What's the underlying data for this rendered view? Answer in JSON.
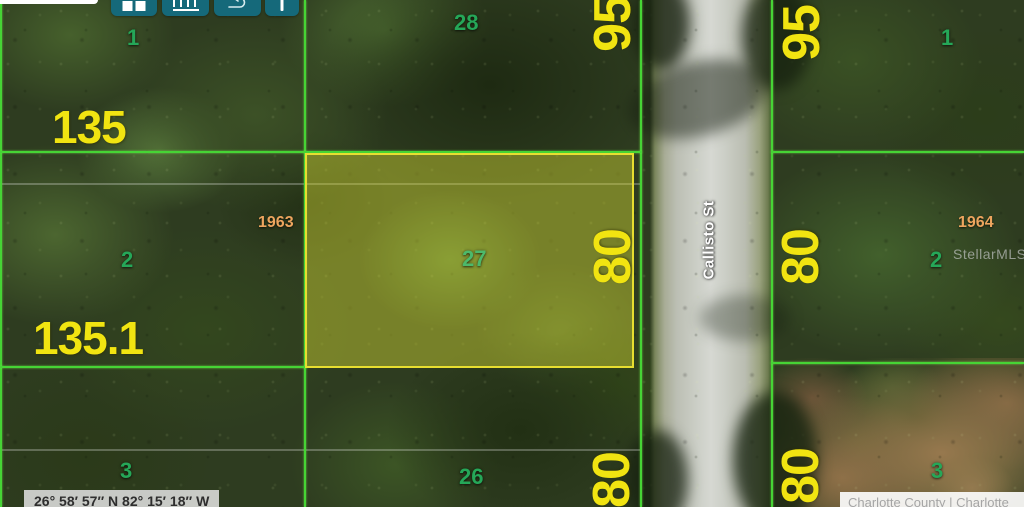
{
  "labels": {
    "street": "Callisto St",
    "watermark": "StellarMLS",
    "coordinates": "26° 58′ 57″ N 82° 15′ 18″ W",
    "attribution": "Charlotte County | Charlotte"
  },
  "toolbar": {
    "buttons": [
      {
        "icon": "grid-icon"
      },
      {
        "icon": "ruler-icon"
      },
      {
        "icon": "draw-arrow-icon"
      },
      {
        "icon": "marker-line-icon"
      }
    ]
  },
  "parcels": {
    "left": {
      "lot1": "1",
      "lot2": "2",
      "lot3": "3",
      "dim_top": "135",
      "dim_mid": "135.1",
      "parcel_id": "1963"
    },
    "center": {
      "lot_top": "28",
      "lot_highlight": "27",
      "lot_bottom": "26",
      "dim_top": "95",
      "dim_mid": "80",
      "dim_bottom": "80"
    },
    "right": {
      "lot1": "1",
      "lot2": "2",
      "lot3": "3",
      "dim_top": "95",
      "dim_mid": "80",
      "dim_bottom": "80",
      "parcel_id": "1964"
    }
  },
  "colors": {
    "boundary_green": "#46d435",
    "lot_number_green": "#25a758",
    "dimension_yellow": "#f1e411",
    "parcel_id_orange": "#eda55e",
    "highlight_yellow": "#e7de30",
    "toolbar_teal": "#15697a"
  }
}
